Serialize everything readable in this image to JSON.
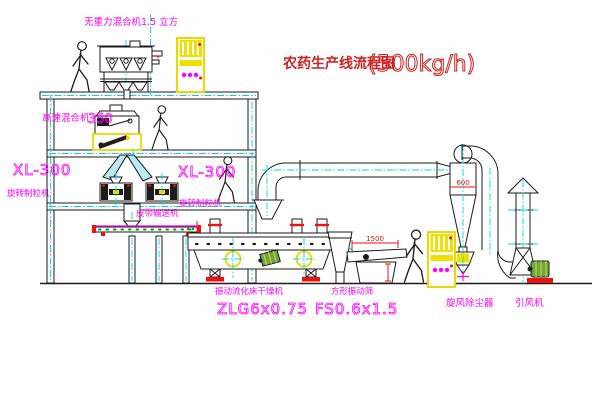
{
  "title": {
    "text": "农药生产线流程图",
    "capacity": "(500kg/h)"
  },
  "colors": {
    "label_magenta": "#ff00ff",
    "title_red": "#cc2222",
    "dimension_red": "#ee1111",
    "cabinet_yellow": "#f0e000",
    "centerline_cyan": "#00d8d8"
  },
  "equipment": {
    "gravity_mixer": {
      "label": "无重力混合机1.5 立方"
    },
    "high_speed_mixer": {
      "label": "高速混合机",
      "model": "350"
    },
    "granulator_left": {
      "model": "XL-300",
      "label": "旋转制粒机"
    },
    "granulator_right": {
      "model": "XL-300",
      "label": "旋转制粒机"
    },
    "belt_conveyor": {
      "label": "皮带输送机"
    },
    "fluid_bed_dryer": {
      "label": "振动流化床干燥机",
      "model": "ZLG6x0.75"
    },
    "vibrating_screen": {
      "label": "方形振动筛",
      "model": "FS0.6x1.5"
    },
    "cyclone": {
      "label": "旋风除尘器"
    },
    "induced_draft_fan": {
      "label": "引风机"
    }
  },
  "dimensions": {
    "screen_length": "1500",
    "cyclone_diameter": "600"
  }
}
